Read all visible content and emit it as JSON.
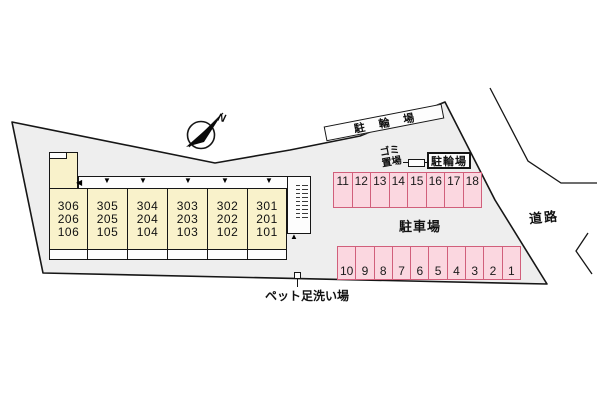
{
  "plan": {
    "compass": {
      "north_label": "N"
    },
    "labels": {
      "bicycle_parking_banner": "駐輪場",
      "bicycle_parking_box": "駐輪場",
      "garbage_area": "ゴミ\n置場",
      "car_parking": "駐車場",
      "road": "道路",
      "pet_foot_wash": "ペット足洗い場"
    },
    "building": {
      "units": [
        {
          "rooms": "306\n206\n106"
        },
        {
          "rooms": "305\n205\n105"
        },
        {
          "rooms": "304\n204\n104"
        },
        {
          "rooms": "303\n203\n103"
        },
        {
          "rooms": "302\n202\n102"
        },
        {
          "rooms": "301\n201\n101"
        }
      ]
    },
    "parking": {
      "top_row": [
        "11",
        "12",
        "13",
        "14",
        "15",
        "16",
        "17",
        "18"
      ],
      "bottom_row": [
        "10",
        "9",
        "8",
        "7",
        "6",
        "5",
        "4",
        "3",
        "2",
        "1"
      ]
    },
    "colors": {
      "site_fill": "#eeeeee",
      "building_fill": "#f9f2cb",
      "parking_fill": "#fbd7e0",
      "parking_border": "#d15f7b",
      "outline": "#161616"
    }
  }
}
